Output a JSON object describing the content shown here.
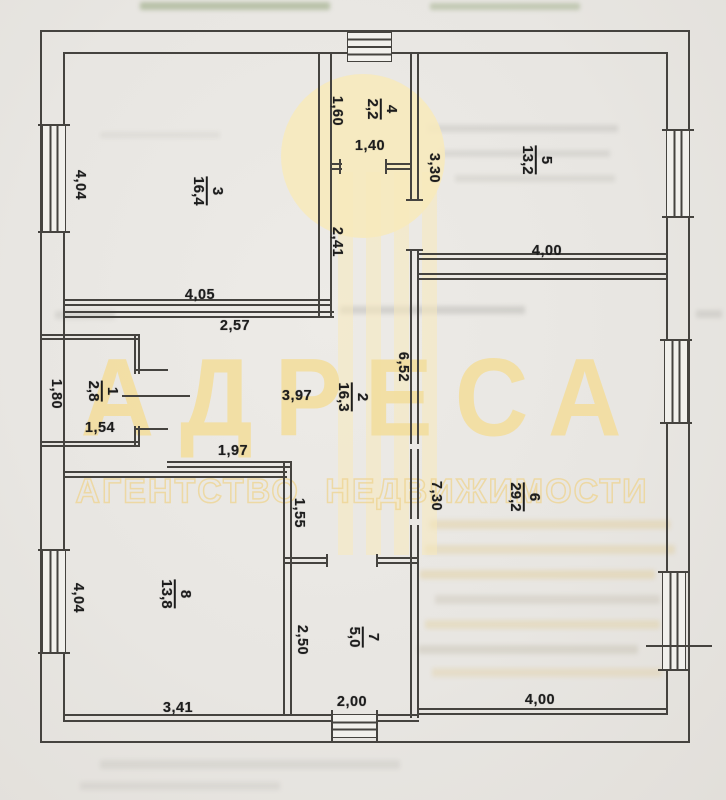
{
  "document_type": "floor-plan-scan",
  "watermark": {
    "title": "АДРЕСА",
    "subtitle": "АГЕНТСТВО НЕДВИЖИМОСТИ"
  },
  "rooms": [
    {
      "number": "3",
      "area": "16,4"
    },
    {
      "number": "4",
      "area": "2,2"
    },
    {
      "number": "5",
      "area": "13,2"
    },
    {
      "number": "1",
      "area": "2,8"
    },
    {
      "number": "2",
      "area": "16,3"
    },
    {
      "number": "6",
      "area": "29,2"
    },
    {
      "number": "8",
      "area": "13,8"
    },
    {
      "number": "7",
      "area": "5,0"
    }
  ],
  "dims": [
    "4,04",
    "4,05",
    "2,57",
    "2,41",
    "1,60",
    "1,40",
    "3,30",
    "4,00",
    "6,52",
    "7,30",
    "3,97",
    "1,97",
    "1,55",
    "1,80",
    "1,54",
    "4,04",
    "3,41",
    "2,50",
    "2,00",
    "4,00"
  ],
  "colors": {
    "wall": "#45433f",
    "paper": "#e8e6e2",
    "ink": "#1d1d1d",
    "watermark": "#f3e2ae"
  }
}
